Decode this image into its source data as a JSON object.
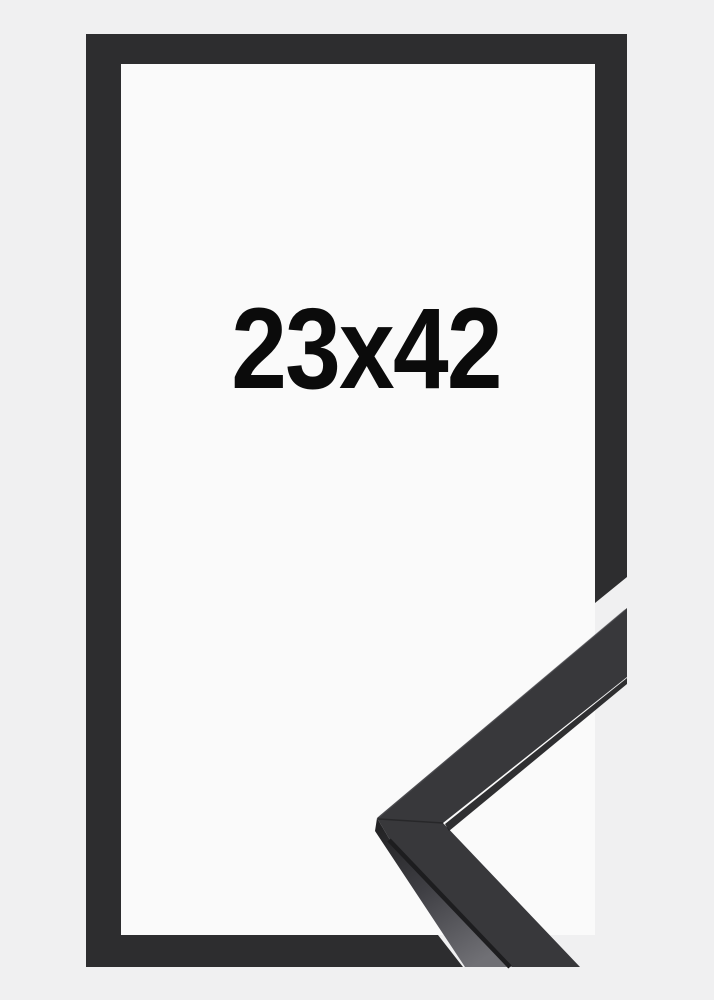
{
  "page": {
    "background_color": "#f0f0f1"
  },
  "frame": {
    "size_label": "23x42",
    "face_color": "#2d2d2f",
    "window_color": "#fafafa",
    "label_color": "#0b0b0b"
  },
  "corner_sample": {
    "top_face_color": "#38383b",
    "underside_edge_color": "#1d1d1f",
    "seam_color": "#1a1a1c",
    "top_edge_highlight_color": "#5a5a5f"
  }
}
